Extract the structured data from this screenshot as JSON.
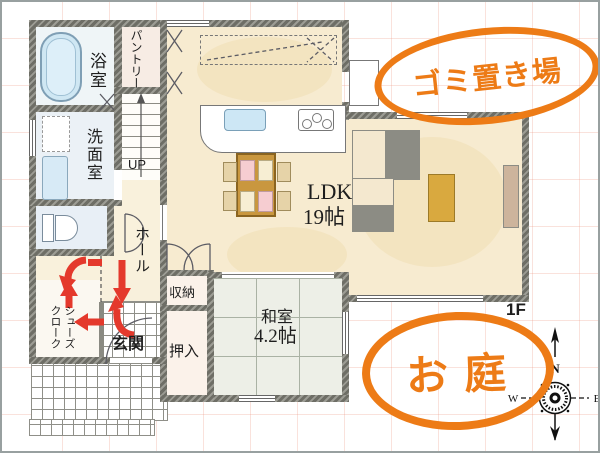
{
  "floor_label": "1F",
  "rooms": {
    "bath": "浴室",
    "pantry": "パントリー",
    "washroom": "洗面室",
    "stairs_up": "UP",
    "hall": "ホール",
    "shoes_cloak": "シューズクローク",
    "entrance": "玄関",
    "storage": "収納",
    "closet": "押入",
    "japanese_room": "和室",
    "japanese_room_size": "4.2帖",
    "ldk": "LDK",
    "ldk_size": "19帖"
  },
  "annotations": {
    "garbage_area": "ゴミ置き場",
    "garden": "お庭"
  },
  "compass": {
    "north": "N",
    "west": "W",
    "east": "E"
  },
  "colors": {
    "accent_orange": "#ED7B16",
    "arrow_red": "#E4392C",
    "wall_gray": "#6E6E66",
    "floor_cream": "#F7EBD0",
    "tatami_green": "#EDEFE7",
    "water_blue": "#CDE7F5"
  }
}
